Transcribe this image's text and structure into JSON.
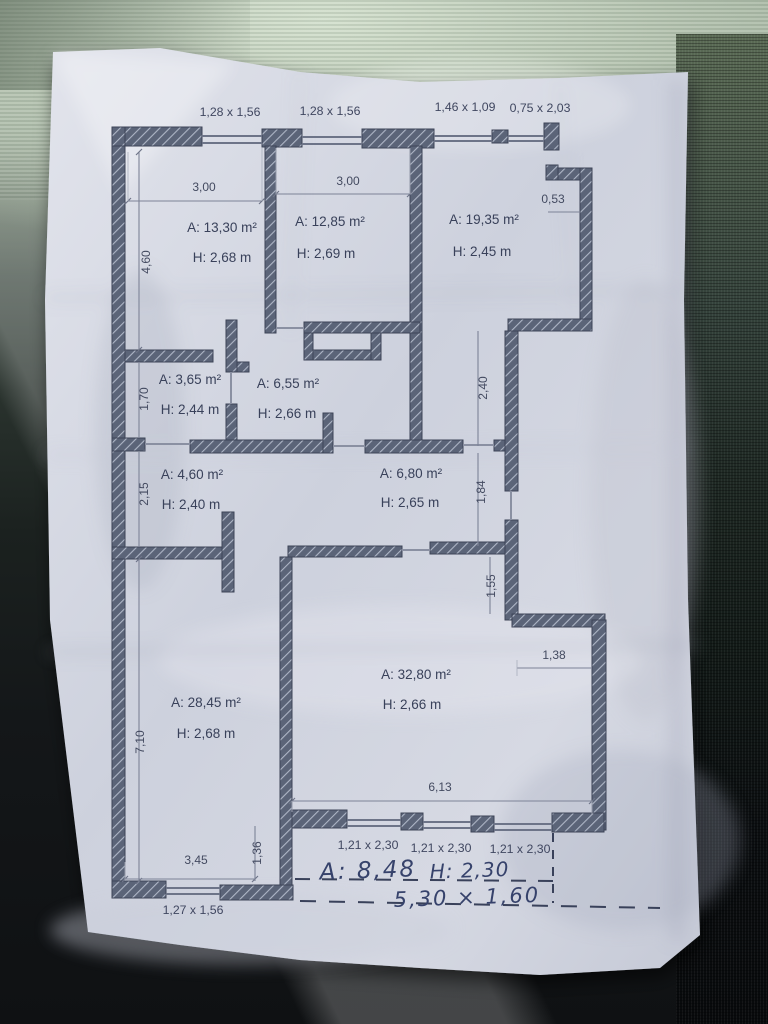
{
  "floor_plan": {
    "rooms": [
      {
        "area": "A: 13,30 m²",
        "height": "H: 2,68 m"
      },
      {
        "area": "A: 12,85 m²",
        "height": "H: 2,69 m"
      },
      {
        "area": "A: 19,35 m²",
        "height": "H: 2,45 m"
      },
      {
        "area": "A: 3,65 m²",
        "height": "H: 2,44 m"
      },
      {
        "area": "A: 6,55 m²",
        "height": "H: 2,66 m"
      },
      {
        "area": "A: 4,60 m²",
        "height": "H: 2,40 m"
      },
      {
        "area": "A: 6,80 m²",
        "height": "H: 2,65 m"
      },
      {
        "area": "A: 28,45 m²",
        "height": "H: 2,68 m"
      },
      {
        "area": "A: 32,80 m²",
        "height": "H: 2,66 m"
      }
    ],
    "window_labels": {
      "top": [
        "1,28 x 1,56",
        "1,28 x 1,56",
        "1,46 x 1,09",
        "0,75 x 2,03"
      ],
      "bottom": [
        "1,21 x 2,30",
        "1,21 x 2,30",
        "1,21 x 2,30"
      ],
      "bottom_left": "1,27 x 1,56"
    },
    "dimensions": {
      "room1_width": "3,00",
      "room2_width": "3,00",
      "niche_width": "0,53",
      "left_upper": "4,60",
      "left_mid_upper": "1,70",
      "left_mid_lower": "2,15",
      "left_lower": "7,10",
      "right_upper": "2,40",
      "right_mid": "1,84",
      "right_lower": "1,55",
      "step_width": "1,38",
      "living_width": "6,13",
      "bottom_width": "3,45",
      "bottom_offset": "1,36"
    },
    "handwriting": {
      "balcony_area": "A: 8,48",
      "balcony_height": "H: 2,30",
      "balcony_size": "5,30 × 1,60"
    },
    "colors": {
      "wall_fill": "#5b6478",
      "wall_outline": "#3d4457",
      "ink": "#39415a",
      "pen_ink": "#36426b",
      "paper": "#d2d5e0"
    }
  }
}
